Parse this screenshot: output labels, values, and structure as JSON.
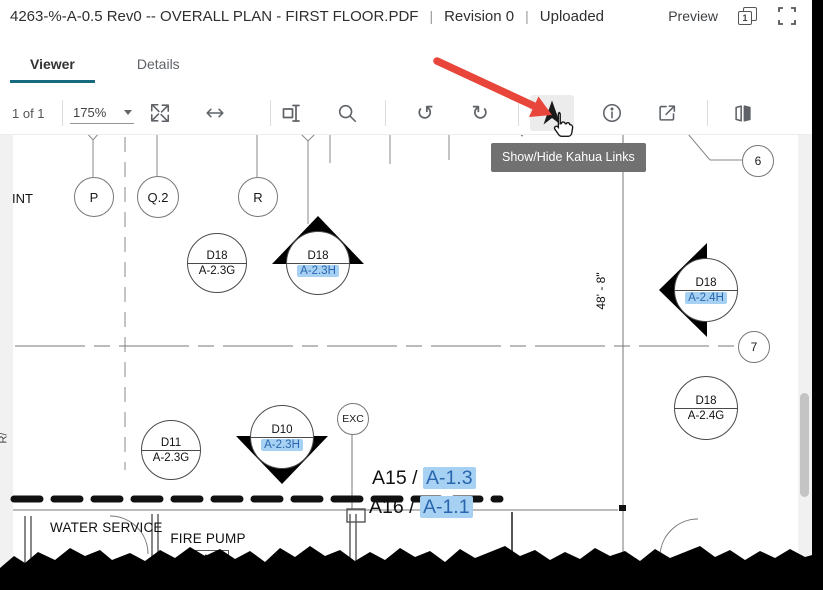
{
  "header": {
    "title": "4263-%-A-0.5 Rev0 -- OVERALL PLAN - FIRST FLOOR.PDF",
    "sep1": "|",
    "revision": "Revision 0",
    "sep2": "|",
    "status": "Uploaded",
    "preview_label": "Preview",
    "page_badge": "1"
  },
  "tabs": [
    {
      "label": "Viewer",
      "active": true
    },
    {
      "label": "Details",
      "active": false
    }
  ],
  "toolbar": {
    "page_indicator": "1 of 1",
    "zoom_level": "175%",
    "icons": [
      "expand-icon",
      "fit-width-icon",
      "text-select-icon",
      "search-icon",
      "rotate-left-icon",
      "rotate-right-icon",
      "kahua-links-icon",
      "info-icon",
      "open-external-icon",
      "compare-icon"
    ],
    "rotate_left_glyph": "↺",
    "rotate_right_glyph": "↻"
  },
  "tooltip": {
    "text": "Show/Hide Kahua Links"
  },
  "annotation": {
    "icons": [
      "red-arrow",
      "hand-cursor"
    ],
    "color": "#e8463b"
  },
  "drawing": {
    "edge_text_left": "INT",
    "edge_text_rotated": "R/",
    "dimension": "48' - 8\"",
    "exc_label": "EXC",
    "grid_bubbles": [
      {
        "label": "P"
      },
      {
        "label": "Q.2"
      },
      {
        "label": "R"
      },
      {
        "label": "6"
      },
      {
        "label": "7"
      }
    ],
    "markers": [
      {
        "top": "D18",
        "bottom": "A-2.3G",
        "highlighted": false,
        "shape": "circle"
      },
      {
        "top": "D18",
        "bottom": "A-2.3H",
        "highlighted": true,
        "shape": "section-up"
      },
      {
        "top": "D18",
        "bottom": "A-2.4H",
        "highlighted": true,
        "shape": "section-left"
      },
      {
        "top": "D18",
        "bottom": "A-2.4G",
        "highlighted": false,
        "shape": "circle"
      },
      {
        "top": "D11",
        "bottom": "A-2.3G",
        "highlighted": false,
        "shape": "circle"
      },
      {
        "top": "D10",
        "bottom": "A-2.3H",
        "highlighted": true,
        "shape": "section-down"
      }
    ],
    "callouts": [
      {
        "prefix": "A15 / ",
        "link": "A-1.3"
      },
      {
        "prefix": "A16 / ",
        "link": "A-1.1"
      }
    ],
    "rooms": [
      {
        "name": "WATER SERVICE"
      },
      {
        "name": "FIRE PUMP",
        "number": "1404"
      }
    ],
    "colors": {
      "link_bg": "#a6d1f3",
      "link_text": "#2a66ad",
      "tab_accent": "#156a7d",
      "tooltip_bg": "#717171"
    }
  }
}
